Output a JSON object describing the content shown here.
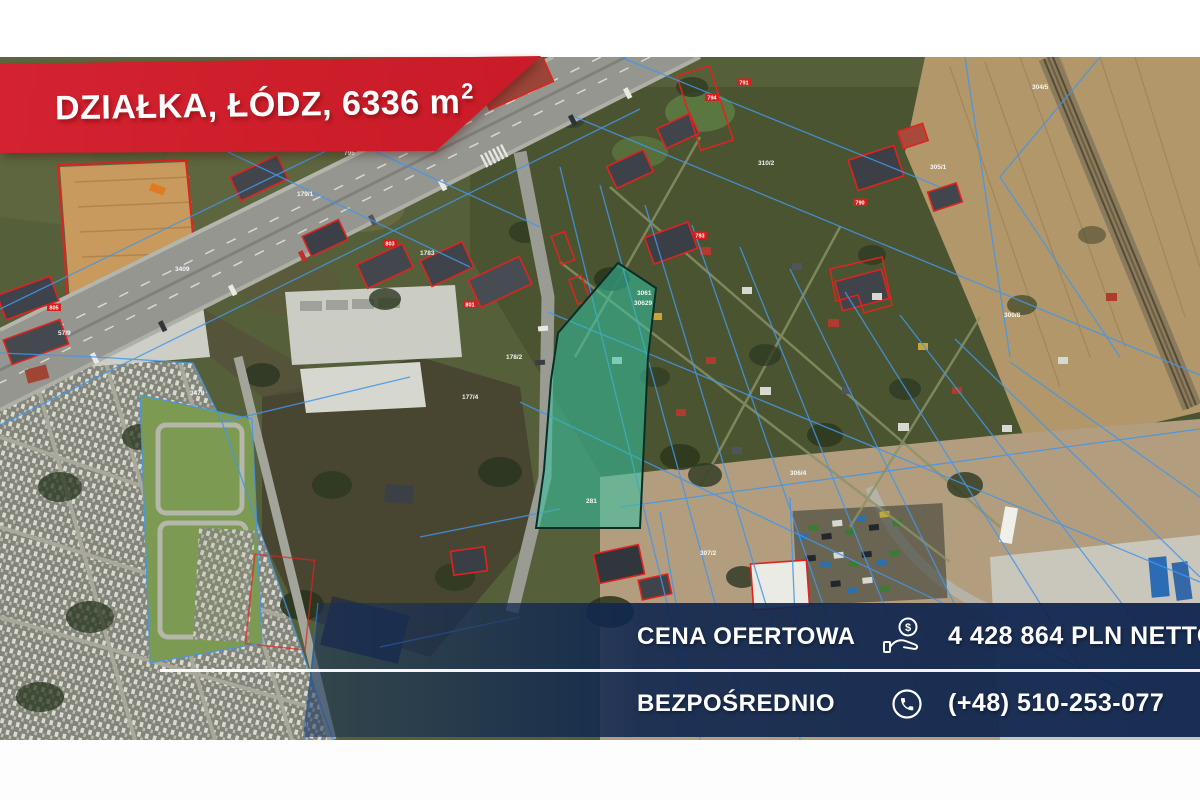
{
  "top_banner": {
    "title_prefix": "DZIAŁKA, ŁÓDZ, 6336 m",
    "title_exponent": "2",
    "bg_color": "#cd1e2a",
    "text_color": "#ffffff"
  },
  "offer_banner": {
    "bg_color": "#14305f",
    "text_color": "#ffffff",
    "rows": [
      {
        "label": "CENA OFERTOWA",
        "icon": "coin-hand-icon",
        "value": "4 428 864 PLN NETTO"
      },
      {
        "label": "BEZPOŚREDNIO",
        "icon": "phone-icon",
        "value": "(+48) 510-253-077"
      }
    ]
  },
  "map": {
    "type": "aerial-cadastral",
    "highlight_plot_color": "#2fbf9f",
    "cadastral_line_color": "#4396ea",
    "building_outline_color": "#e0231f",
    "parcel_labels": [
      {
        "t": "3409",
        "x": 175,
        "y": 214
      },
      {
        "t": "179/1",
        "x": 297,
        "y": 139
      },
      {
        "t": "1783",
        "x": 420,
        "y": 198
      },
      {
        "t": "57/9",
        "x": 58,
        "y": 278
      },
      {
        "t": "3470",
        "x": 190,
        "y": 338
      },
      {
        "t": "796",
        "x": 344,
        "y": 98
      },
      {
        "t": "310/2",
        "x": 758,
        "y": 108
      },
      {
        "t": "304/5",
        "x": 1032,
        "y": 32
      },
      {
        "t": "300/8",
        "x": 1004,
        "y": 260
      },
      {
        "t": "306/4",
        "x": 790,
        "y": 418
      },
      {
        "t": "281",
        "x": 586,
        "y": 446
      },
      {
        "t": "3061",
        "x": 637,
        "y": 238
      },
      {
        "t": "30629",
        "x": 634,
        "y": 248
      },
      {
        "t": "178/2",
        "x": 506,
        "y": 302
      },
      {
        "t": "177/4",
        "x": 462,
        "y": 342
      },
      {
        "t": "307/2",
        "x": 700,
        "y": 498
      },
      {
        "t": "305/1",
        "x": 930,
        "y": 112
      }
    ],
    "building_labels": [
      {
        "t": "794",
        "x": 712,
        "y": 42
      },
      {
        "t": "791",
        "x": 744,
        "y": 27
      },
      {
        "t": "793",
        "x": 700,
        "y": 180
      },
      {
        "t": "790",
        "x": 860,
        "y": 147
      },
      {
        "t": "801",
        "x": 470,
        "y": 249
      },
      {
        "t": "805",
        "x": 54,
        "y": 252
      },
      {
        "t": "803",
        "x": 390,
        "y": 188
      }
    ]
  }
}
